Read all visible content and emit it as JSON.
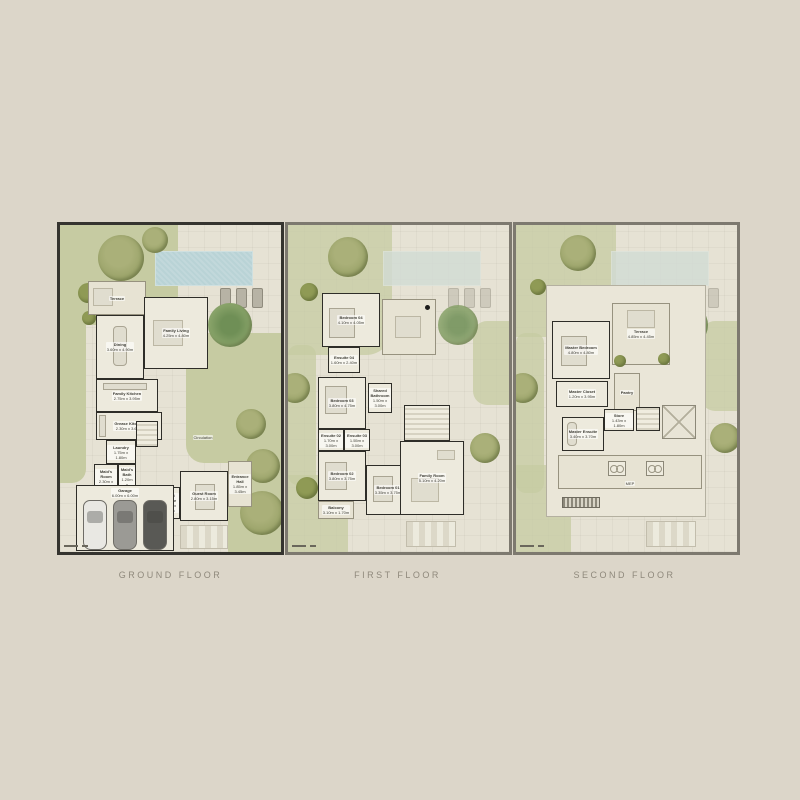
{
  "page": {
    "background": "#dcd6c9",
    "type": "villa-floor-plans"
  },
  "colors": {
    "lawn": "#c6cba2",
    "pool": "#b9d3d6",
    "wall": "#2e2d28",
    "paving": "#e6e2d4",
    "plan_border_dark": "#35342f",
    "plan_border_gray": "#7d796f",
    "caption_text": "#8f897c"
  },
  "plans": [
    {
      "name": "GROUND FLOOR",
      "features": {
        "pool": "swimming-pool",
        "sun_loungers": 3,
        "garage_cars": 3
      },
      "rooms": [
        {
          "label": "Terrace",
          "dims": ""
        },
        {
          "label": "Dining",
          "dims": "3.60m x 4.90m"
        },
        {
          "label": "Family Living",
          "dims": "4.25m x 4.80m"
        },
        {
          "label": "Family Kitchen",
          "dims": "2.75m x 3.95m"
        },
        {
          "label": "Grease Kitchen",
          "dims": "2.30m x 3.60m"
        },
        {
          "label": "Laundry",
          "dims": "1.75m x 1.80m"
        },
        {
          "label": "Maid's Room",
          "dims": "2.30m x 2.45m"
        },
        {
          "label": "Maid's Bath",
          "dims": "1.20m x 1.95m"
        },
        {
          "label": "Driver's Room",
          "dims": "2.35m x 2.45m"
        },
        {
          "label": "Driver's Bath",
          "dims": "1.20m x 1.95m"
        },
        {
          "label": "Powder Room",
          "dims": "1.80m x 1.50m"
        },
        {
          "label": "Circulation",
          "dims": ""
        },
        {
          "label": "Guest Ensuite",
          "dims": "1.75m x 3.05m"
        },
        {
          "label": "Guest Room",
          "dims": "2.80m x 3.15m"
        },
        {
          "label": "Entrance Hall",
          "dims": "1.85m x 3.45m"
        },
        {
          "label": "Garage",
          "dims": "6.00m x 6.00m"
        }
      ]
    },
    {
      "name": "FIRST FLOOR",
      "features": {
        "pool": "swimming-pool-ghosted"
      },
      "rooms": [
        {
          "label": "Bedroom 04",
          "dims": "4.10m x 4.05m"
        },
        {
          "label": "Ensuite 04",
          "dims": "1.60m x 2.40m"
        },
        {
          "label": "Bedroom 03",
          "dims": "3.80m x 4.75m"
        },
        {
          "label": "Shared Bathroom",
          "dims": "1.50m x 3.00m"
        },
        {
          "label": "Ensuite 02",
          "dims": "1.70m x 3.00m"
        },
        {
          "label": "Ensuite 03",
          "dims": "1.55m x 3.00m"
        },
        {
          "label": "Bedroom 02",
          "dims": "3.80m x 3.75m"
        },
        {
          "label": "Bedroom 01",
          "dims": "3.35m x 3.75m"
        },
        {
          "label": "Balcony",
          "dims": "3.10m x 1.70m"
        },
        {
          "label": "Family Room",
          "dims": "5.10m x 4.20m"
        }
      ]
    },
    {
      "name": "SECOND FLOOR",
      "features": {
        "pool": "swimming-pool-ghosted",
        "ac_units": 2
      },
      "rooms": [
        {
          "label": "Master Bedroom",
          "dims": "4.80m x 4.80m"
        },
        {
          "label": "Terrace",
          "dims": "4.85m x 4.45m"
        },
        {
          "label": "Master Closet",
          "dims": "1.20m x 3.95m"
        },
        {
          "label": "Pantry",
          "dims": ""
        },
        {
          "label": "Store",
          "dims": "1.43m x 1.80m"
        },
        {
          "label": "Master Ensuite",
          "dims": "3.40m x 3.70m"
        },
        {
          "label": "MEP",
          "dims": ""
        }
      ]
    }
  ]
}
